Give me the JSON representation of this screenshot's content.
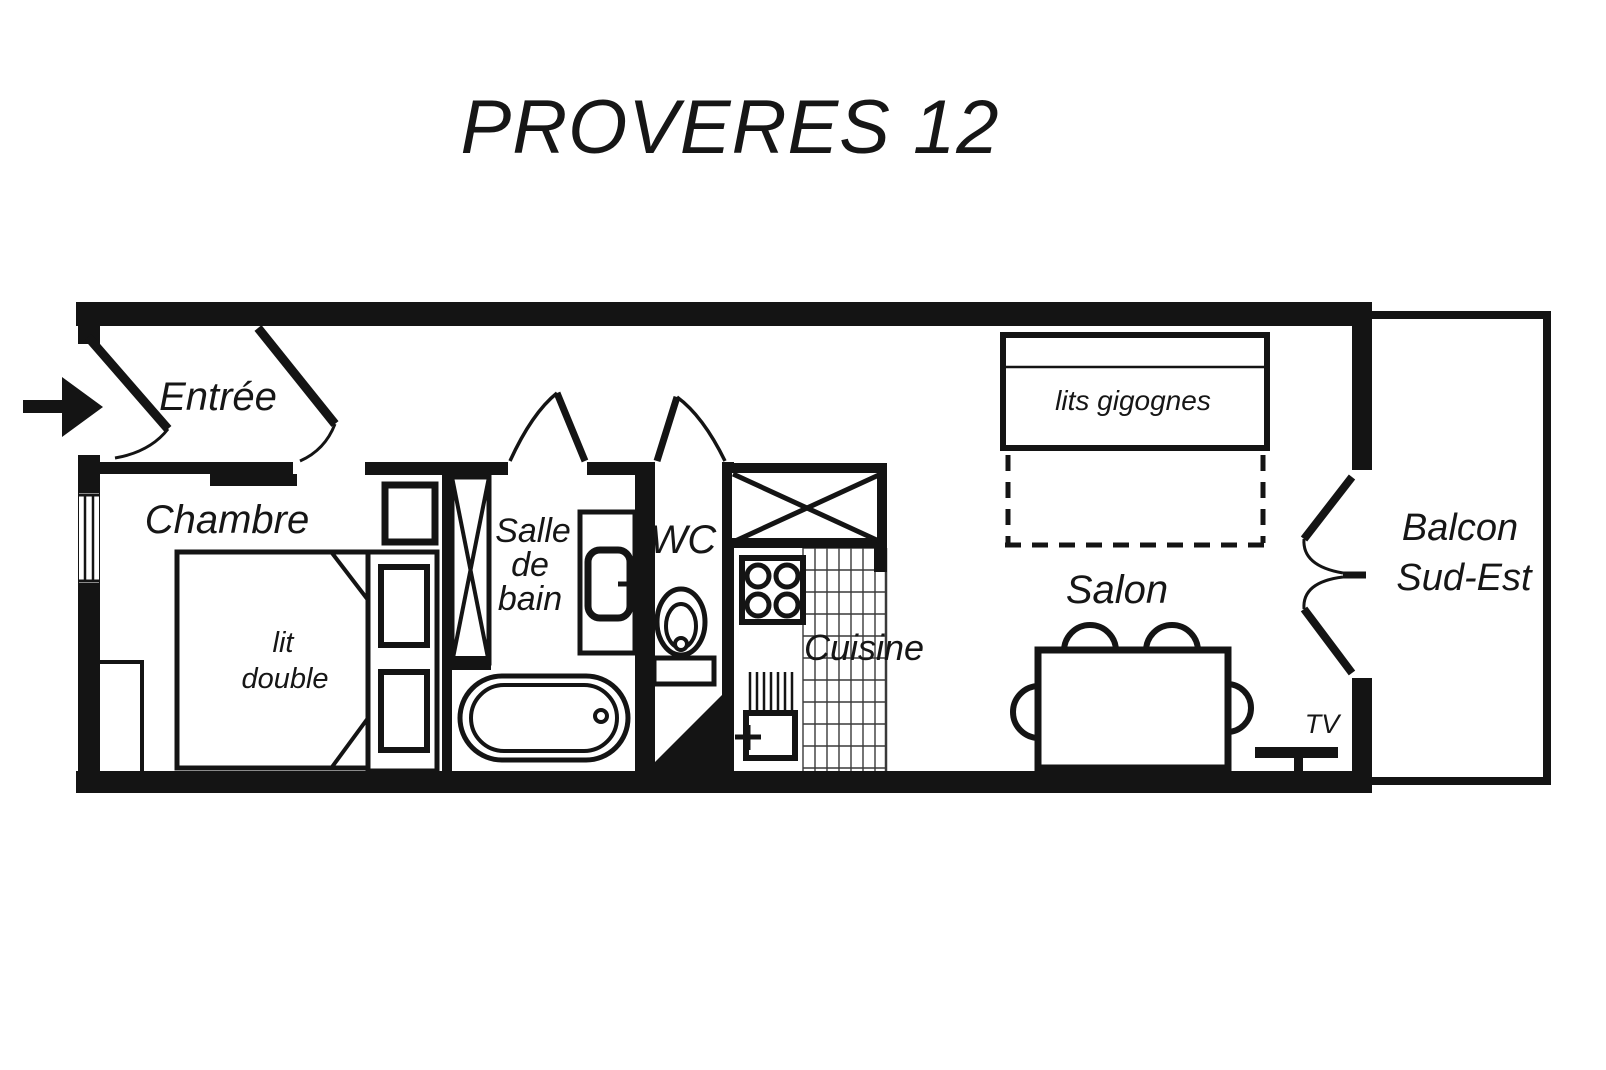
{
  "title": "PROVERES 12",
  "colors": {
    "ink": "#141414",
    "paper": "#ffffff"
  },
  "rooms": {
    "entree": {
      "label": "Entrée"
    },
    "chambre": {
      "label": "Chambre",
      "bed_line1": "lit",
      "bed_line2": "double"
    },
    "salle_de_bain": {
      "line1": "Salle",
      "line2": "de",
      "line3": "bain"
    },
    "wc": {
      "label": "WC"
    },
    "cuisine": {
      "label": "Cuisine"
    },
    "salon": {
      "label": "Salon",
      "nested_beds_label": "lits gigognes",
      "tv_label": "TV"
    },
    "balcon": {
      "line1": "Balcon",
      "line2": "Sud-Est"
    }
  }
}
